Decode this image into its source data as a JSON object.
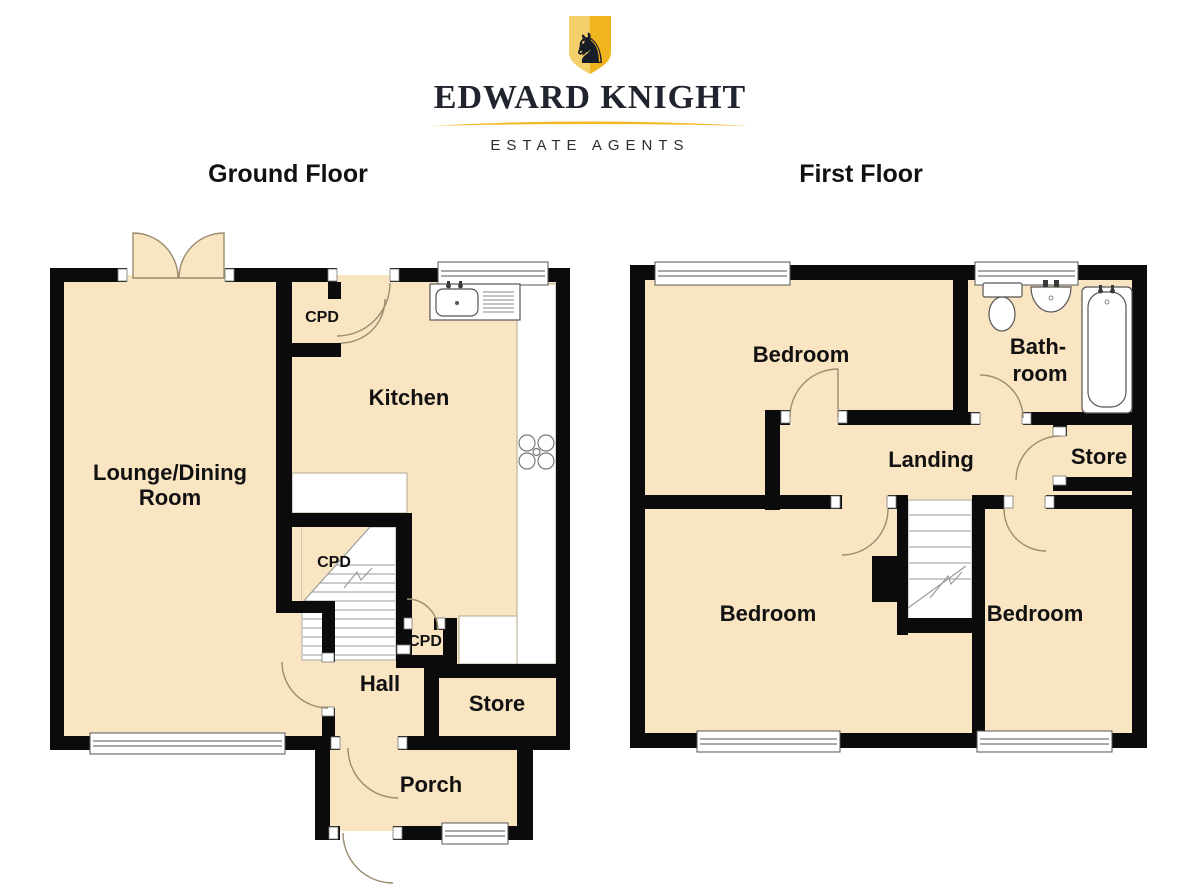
{
  "brand": {
    "name": "EDWARD KNIGHT",
    "tagline": "ESTATE AGENTS",
    "knight_glyph": "♞",
    "shield_light": "#f3d06a",
    "shield_dark": "#efb41e",
    "text_navy": "#20242e",
    "swoosh_gold": "#f2b722"
  },
  "plan_style": {
    "wall_color": "#0b0b0b",
    "floor_fill": "#fae5c2",
    "door_arc_color": "#9a8c6e",
    "fixture_line_color": "#555555"
  },
  "ground_floor": {
    "title": "Ground Floor",
    "rooms": {
      "lounge_line1": "Lounge/Dining",
      "lounge_line2": "Room",
      "kitchen": "Kitchen",
      "cupboard_top": "CPD",
      "cupboard_stairs": "CPD",
      "cupboard_hall": "CPD",
      "hall": "Hall",
      "store": "Store",
      "porch": "Porch"
    }
  },
  "first_floor": {
    "title": "First Floor",
    "rooms": {
      "bedroom_front": "Bedroom",
      "bathroom_line1": "Bath-",
      "bathroom_line2": "room",
      "landing": "Landing",
      "store": "Store",
      "bedroom_left": "Bedroom",
      "bedroom_right": "Bedroom"
    }
  }
}
